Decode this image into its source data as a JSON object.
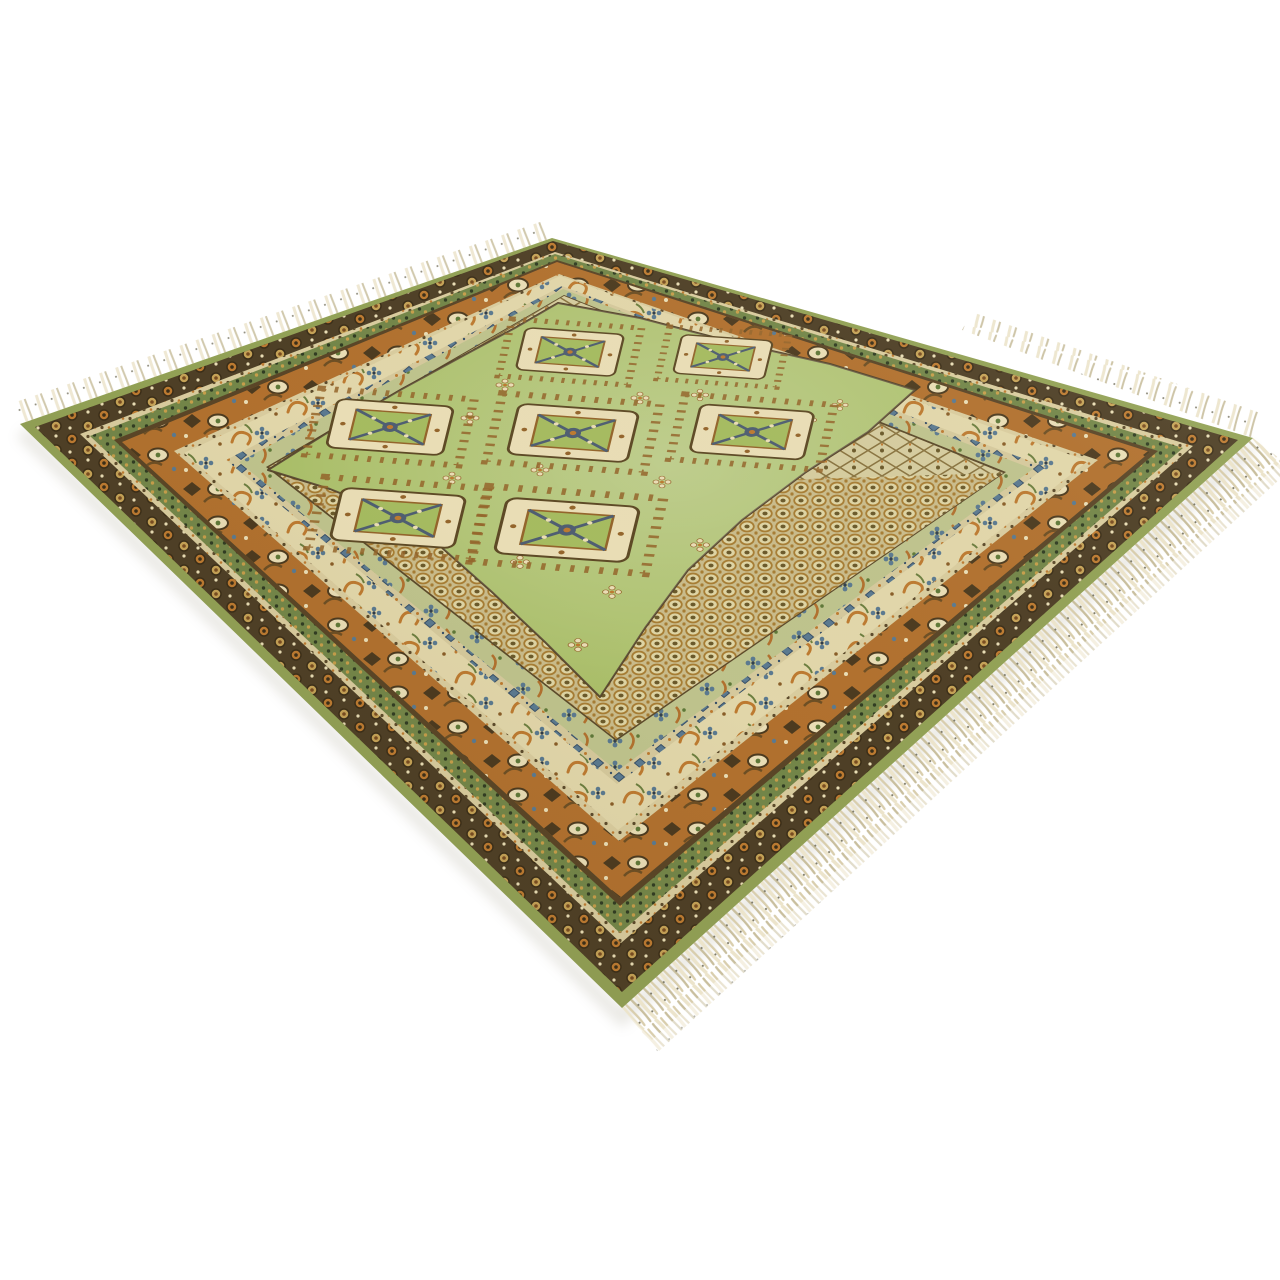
{
  "image": {
    "type": "product photograph",
    "subject": "Vintage hand-knotted area rug in olive green, shown at a perspective angle on a white background, with seven cream square medallions on a green stepped-diamond field, cream trellis and honeycomb spandrels, multiple ornamental borders in orange, dark brown, cream and blue, green edge binding, and cream fringe tassels along the near edges",
    "background": "#ffffff",
    "medallion_count": 7,
    "fringe": "cream tassels"
  },
  "colors": {
    "bg": "#ffffff",
    "edge_green": "#94a457",
    "band_dark": "#4e3f26",
    "cream_guard": "#ddd0a2",
    "band_green": "#74884a",
    "guard_dark": "#5a4527",
    "border_orange": "#b4722f",
    "cream_band": "#e6dbae",
    "guard_blue_base": "#d9cda0",
    "blue": "#5b7b93",
    "band_lightgreen": "#c2c790",
    "line_brown": "#5c4a2b",
    "interior_base": "#cdbf8e",
    "lattice_base": "#d9d0a2",
    "lattice_line": "#8a7440",
    "honey_line": "#a97f35",
    "honey_cell": "#e3d9a8",
    "honey_dot": "#6b5a2b",
    "field_green": "#a8bf62",
    "gul_cream": "#eee2ba",
    "gul_outline": "#5e4a26",
    "hook_brown": "#96662c",
    "x_slate": "#4f5f74",
    "orange_motif": "#c07c31",
    "fringe_cream": "#ece4cb",
    "fringe_shadow": "#c9bf9e",
    "fringe_mid": "#d9cead",
    "fleck": "#7d7a68",
    "shadow": "#cfccc2"
  }
}
